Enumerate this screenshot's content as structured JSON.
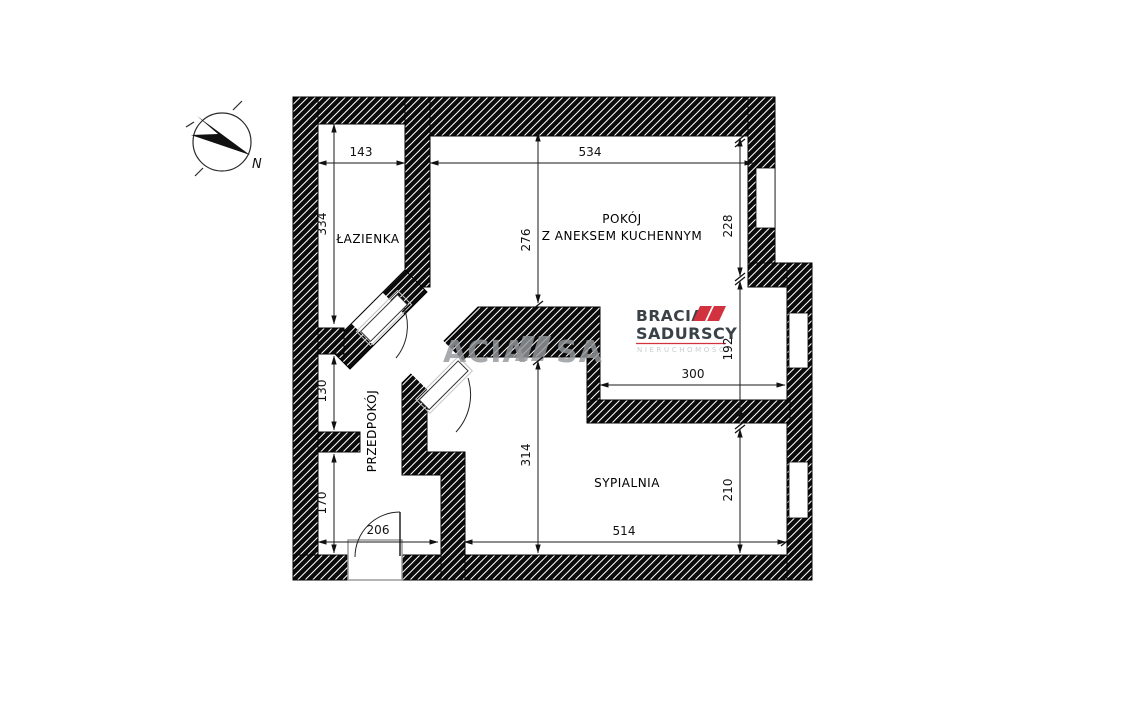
{
  "compass": {
    "north": "N"
  },
  "watermark": {
    "left": "ACIA",
    "right": "SA"
  },
  "logo": {
    "brand1": "BRACIA",
    "brand2": "SADURSCY",
    "tagline": "NIERUCHOMOŚCI"
  },
  "rooms": {
    "bathroom": "ŁAZIENKA",
    "living1": "POKÓJ",
    "living2": "Z ANEKSEM KUCHENNYM",
    "hall": "PRZEDPOKÓJ",
    "bedroom": "SYPIALNIA"
  },
  "dims": {
    "bath_w": "143",
    "bath_h": "334",
    "liv_w": "534",
    "liv_h_left": "276",
    "liv_h_right": "228",
    "kitchen_h": "192",
    "kitchen_w": "300",
    "hall_upper": "130",
    "hall_lower": "170",
    "entry_w": "206",
    "bed_h_left": "314",
    "bed_h_right": "210",
    "bed_w": "514"
  },
  "colors": {
    "accent": "#d2323e",
    "logo_text": "#3a4147",
    "tagline": "#c9cdd0",
    "watermark": "#95999c",
    "wall": "#0b0b0b"
  }
}
